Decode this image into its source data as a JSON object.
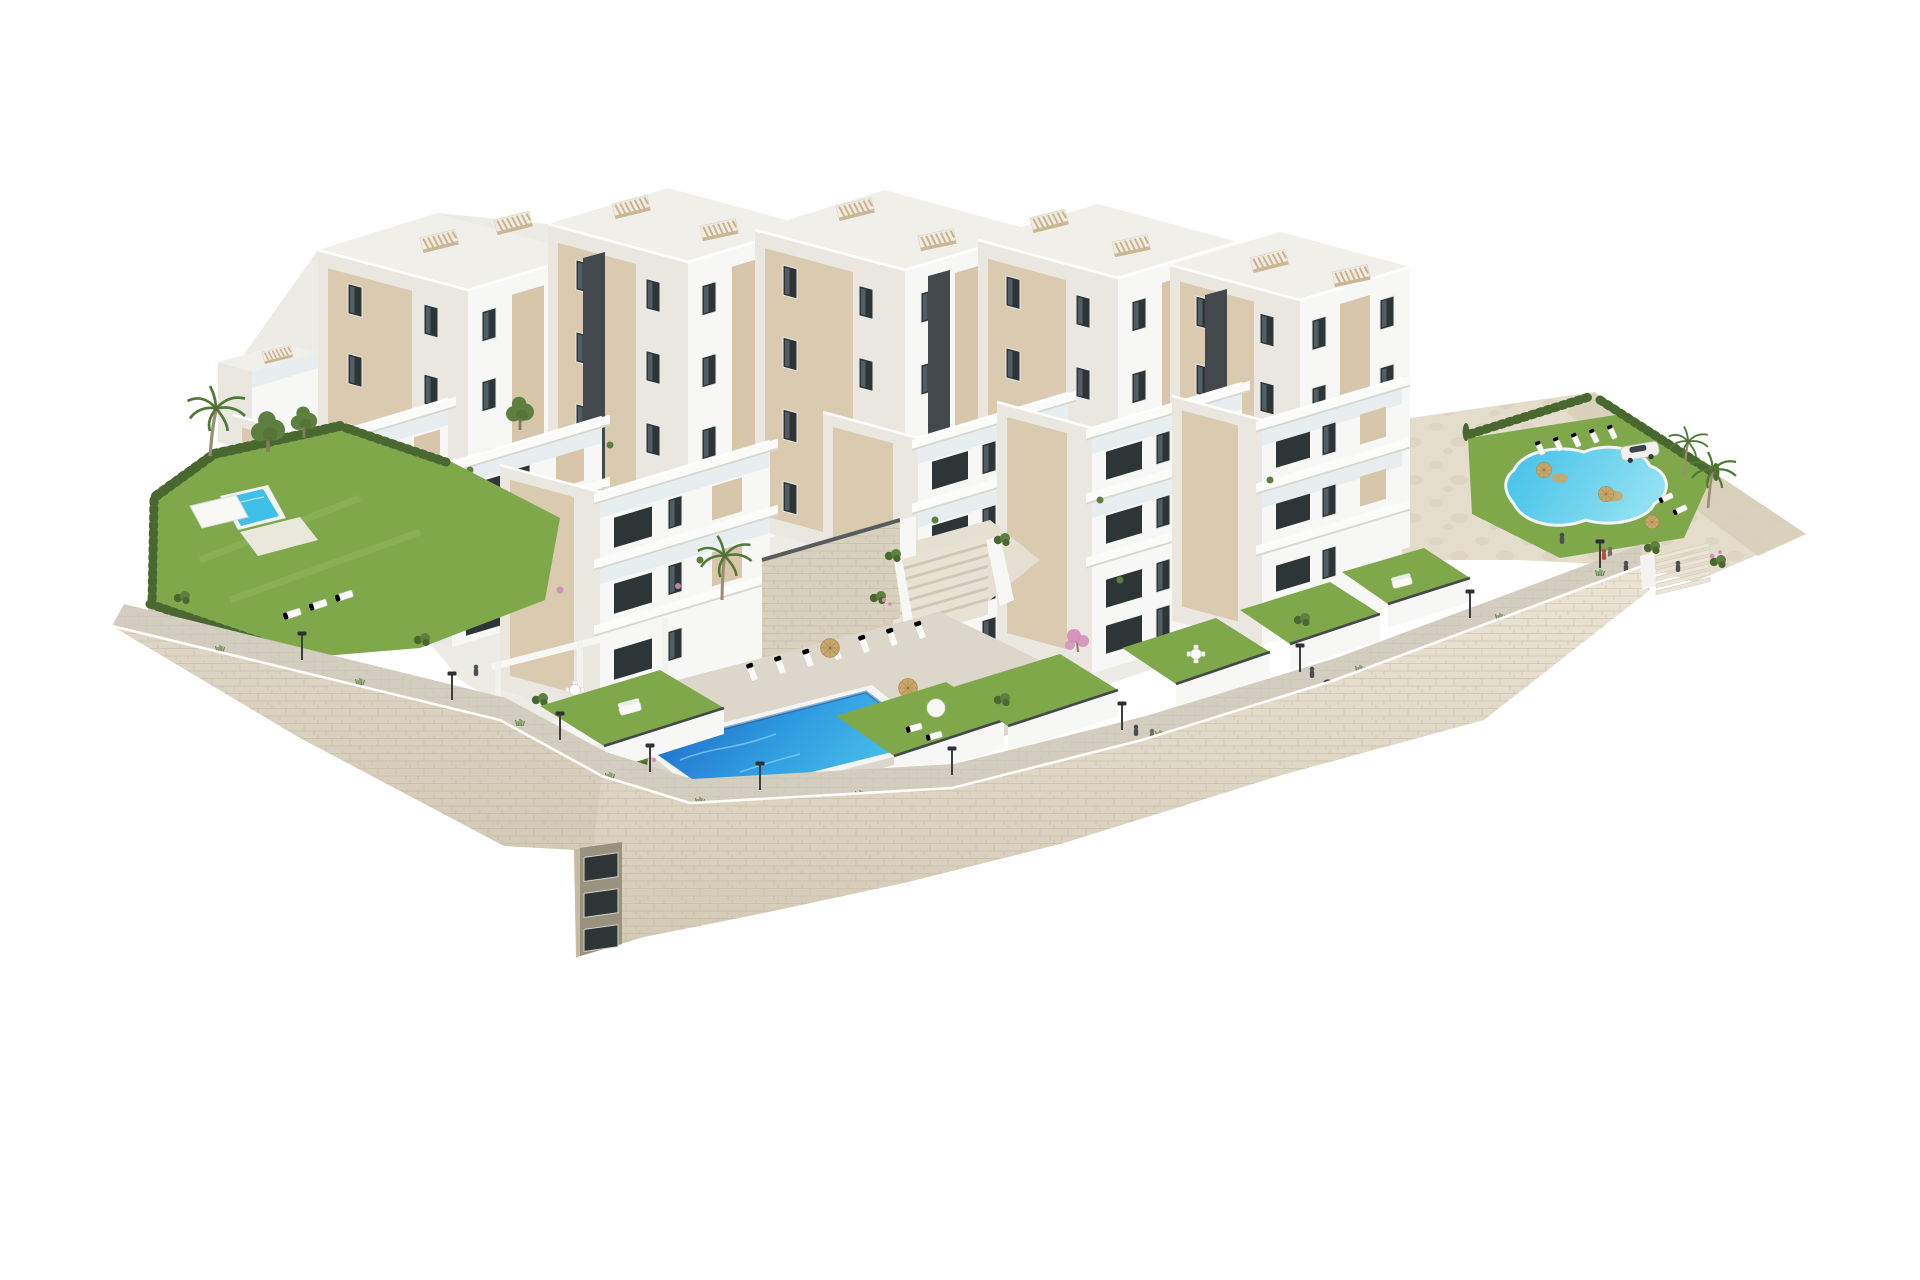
{
  "scene": {
    "type": "architectural-3d-render",
    "description": "Aerial 3D rendering of a modern hillside residential complex: stepped white apartment blocks with beige panels and glass balconies, rooftop pergolas, private lawned gardens, three swimming pools, palm and cypress landscaping, a curved promenade with street lamps, all sitting on a rustic stone retaining wall, isolated on a pure white background",
    "background": "#ffffff"
  },
  "colors": {
    "background": "#ffffff",
    "facade_white": "#f7f7f5",
    "facade_light": "#e9e7e0",
    "roof_light": "#f1efe9",
    "panel_beige": "#d8c6ab",
    "panel_beige_dark": "#c3b193",
    "core_dark": "#42484b",
    "window_dark": "#2e3537",
    "window_glass": "#6f828c",
    "glass_rail": "#dde8eb",
    "pergola_beige": "#c9b38d",
    "lawn_green": "#7fa84b",
    "hedge_green": "#49682f",
    "tree_green": "#5d7f3f",
    "palm_green": "#4e7a36",
    "pool_deep": "#1a5fc4",
    "pool_mid": "#2f9be0",
    "pool_light": "#49c0ea",
    "pool_turquoise": "#3fc0e8",
    "lagoon_light": "#8fe0f2",
    "stone_light": "#e8e1d1",
    "stone_mid": "#d9d1bf",
    "stone_dark": "#c6bba3",
    "stone_line": "#b7ac94",
    "paver_light": "#e4ddcb",
    "promenade_gray": "#d4cec0",
    "deck_gray": "#dcd7ca",
    "wall_grad_top": "#ece5d6",
    "wall_grad_bottom": "#d3cab5",
    "straw_tan": "#c8a76b",
    "car_white": "#f1f1ef",
    "fence_dark": "#43484a",
    "person_dark": "#4c4f52",
    "person_accent": "#b05040",
    "flower_pink": "#d489b8"
  },
  "objects": {
    "apartment_blocks_back_row": 5,
    "apartment_blocks_front_row": 6,
    "rooftop_pergolas": 10,
    "swimming_pools": 3,
    "pool_names": [
      "left garden pool",
      "central community pool",
      "right lagoon pool"
    ],
    "private_garden_plots": 6,
    "palm_trees": 6,
    "pine_trees": 3,
    "street_lamps": 10,
    "sun_loungers": 20,
    "straw_parasols": 7,
    "cars": 1,
    "pedestrians": 8,
    "retaining_wall": "rustic stone masonry wrapping the lower terraces",
    "service_shaft": "dark lift shaft set into the stone wall"
  }
}
